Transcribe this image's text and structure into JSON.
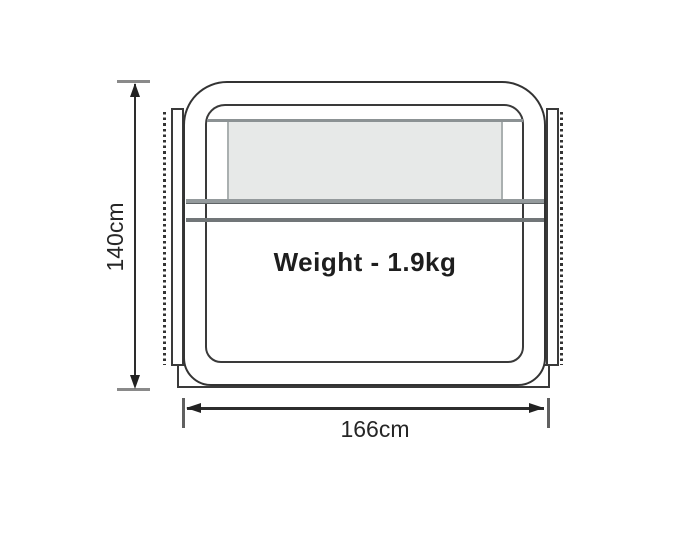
{
  "diagram": {
    "weight_label": "Weight - 1.9kg",
    "height_dimension": "140cm",
    "width_dimension": "166cm",
    "colors": {
      "outline": "#333333",
      "dimension_line": "#2d2d2d",
      "tick_gray": "#8a8a8a",
      "rail_gray": "#8c9294",
      "window_fill": "#e7e9e8",
      "text": "#1e1e1e",
      "background": "#ffffff"
    }
  }
}
